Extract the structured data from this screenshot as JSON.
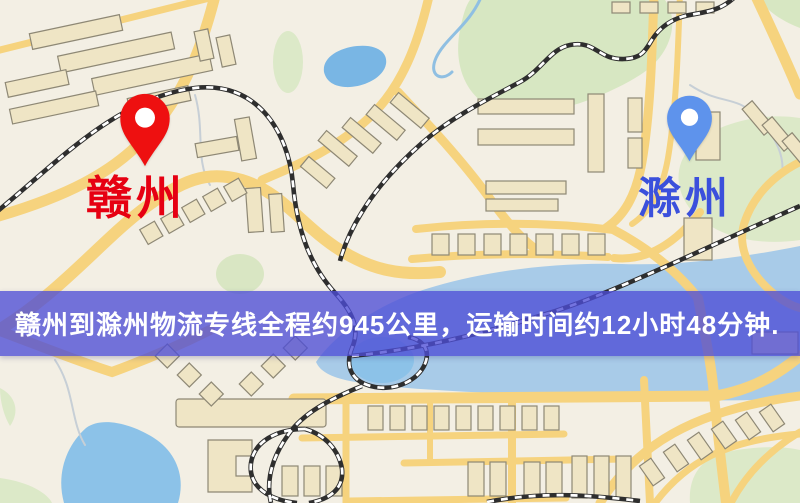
{
  "map": {
    "origin": {
      "label": "赣州",
      "pin_color": "#EE1010",
      "label_color": "#E60012"
    },
    "destination": {
      "label": "滁州",
      "pin_color": "#5E93EC",
      "label_color": "#3B50DC"
    },
    "palette": {
      "background": "#F3EFE4",
      "road": "#F6D37E",
      "building": "#EFE5C5",
      "building_outline": "#8E8875",
      "green_area": "#D7E7C2",
      "water": "#A8CBE8",
      "lake": "#7FB9E4",
      "railway": "#2E2E2E"
    }
  },
  "banner": {
    "text": "赣州到滁州物流专线全程约945公里，运输时间约12小时48分钟.",
    "background": "rgba(77,77,214,0.78)",
    "text_color": "#FFFFFF",
    "origin_city": "赣州",
    "destination_city": "滁州",
    "distance": "约945公里",
    "duration": "约12小时48分钟"
  }
}
